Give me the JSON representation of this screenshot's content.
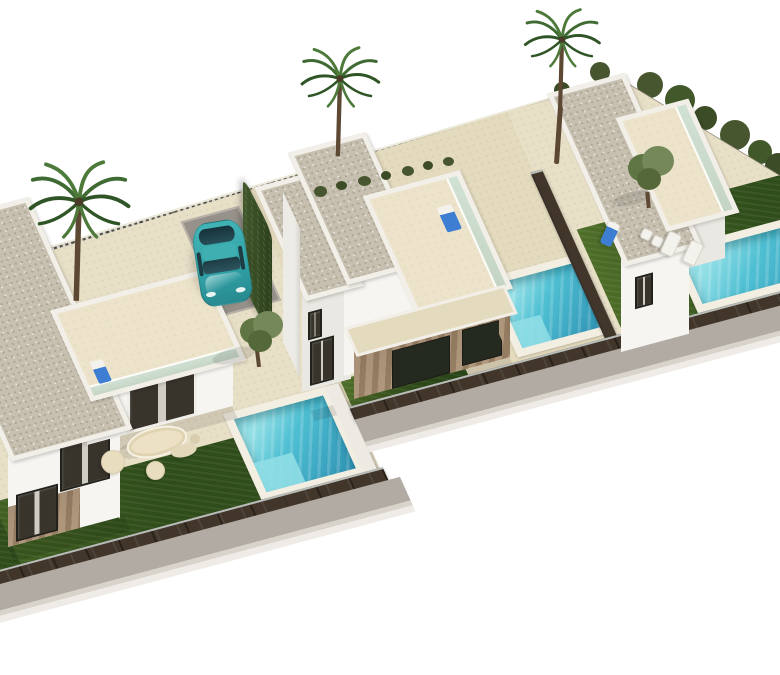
{
  "scene": {
    "title": "Aerial 3D architectural render of three modern two-storey villas with private pools",
    "background": "plain white studio backdrop",
    "view": "high oblique aerial, scene strip runs diagonally from lower-left to upper-right"
  },
  "inventory": {
    "villas": [
      {
        "name": "villa-left",
        "storeys": 2,
        "roof": "flat gravel roof",
        "roof_terrace": true,
        "stone_clad_base": true,
        "pool": true,
        "lawn_strip": true,
        "outdoor_lounge_set": true
      },
      {
        "name": "villa-middle",
        "storeys": 2,
        "roof": "flat gravel roof",
        "roof_terrace": true,
        "stone_clad_base": true,
        "pool": true,
        "front_lawn": true,
        "parked_car": true,
        "roof_lounger_with_blue_towel": true
      },
      {
        "name": "villa-right",
        "storeys": 2,
        "roof": "flat gravel roof",
        "roof_terrace": true,
        "stone_clad_base": true,
        "pool": true,
        "lawn": true,
        "sun_loungers": 4,
        "blue_lounger": 1
      }
    ],
    "pool_count": 3,
    "vehicle": {
      "type": "compact hatchback",
      "color_name": "teal",
      "state": "parked on driveway pad"
    },
    "vegetation": {
      "palm_trees": 3,
      "olive_trees": 2,
      "boundary_hedge": true,
      "perimeter_shrubs": true
    },
    "boundary": {
      "back_fence": "dark posts with light breeze-block lattice panels",
      "front_fences": "dark timber slat fence with light metal top rail",
      "sidewalk": "grey pavement strip with pale curb"
    }
  },
  "colors": {
    "bg": "#ffffff",
    "wall_bright": "#f6f5f1",
    "wall_soft": "#e9e8e2",
    "wall_shade": "#dedcd5",
    "parapet": "#f1efe8",
    "roof_gravel": "#c7c0b1",
    "roof_gravel_dot": "#afa795",
    "roof_cream": "#ece3ca",
    "sand": "#e8dfc7",
    "sand_warm": "#e4dabe",
    "lawn_a": "#4e6e28",
    "lawn_b": "#2f4d1a",
    "water": "#4fc0d3",
    "water_deep": "#2f92b4",
    "water_light": "#93dfe6",
    "coping": "#f2eee2",
    "fence_wood": "#42362a",
    "fence_dark": "#2a211a",
    "fence_rail": "#b9bdba",
    "lattice_light": "#d8d7cf",
    "lattice_dark": "#57534a",
    "sidewalk": "#b2aba3",
    "curb": "#d8d3cb",
    "driveway": "#96918a",
    "hedge_dark": "#2c401b",
    "hedge_light": "#41582a",
    "frond_a": "#3f6b33",
    "frond_b": "#4d7a3a",
    "frond_c": "#2f5526",
    "trunk": "#5d4833",
    "olive_a": "#5f7544",
    "olive_b": "#74885a",
    "car_body": "#31a4a9",
    "car_roof": "#3fafb2",
    "car_glass": "#1d3c43",
    "white_item": "#f4f2ec",
    "towel_blue": "#3e7ed2",
    "window_glass": "#38342c",
    "window_frame": "#23211c",
    "stone_a": "#b0987d",
    "stone_b": "#967e63",
    "door_dark": "#242a20",
    "shadow10": "rgba(0,0,0,0.10)",
    "shadow16": "rgba(0,0,0,0.16)",
    "glass_rail": "#bee1dc",
    "shrub_a": "#47562e",
    "shrub_b": "#3c4c26"
  }
}
